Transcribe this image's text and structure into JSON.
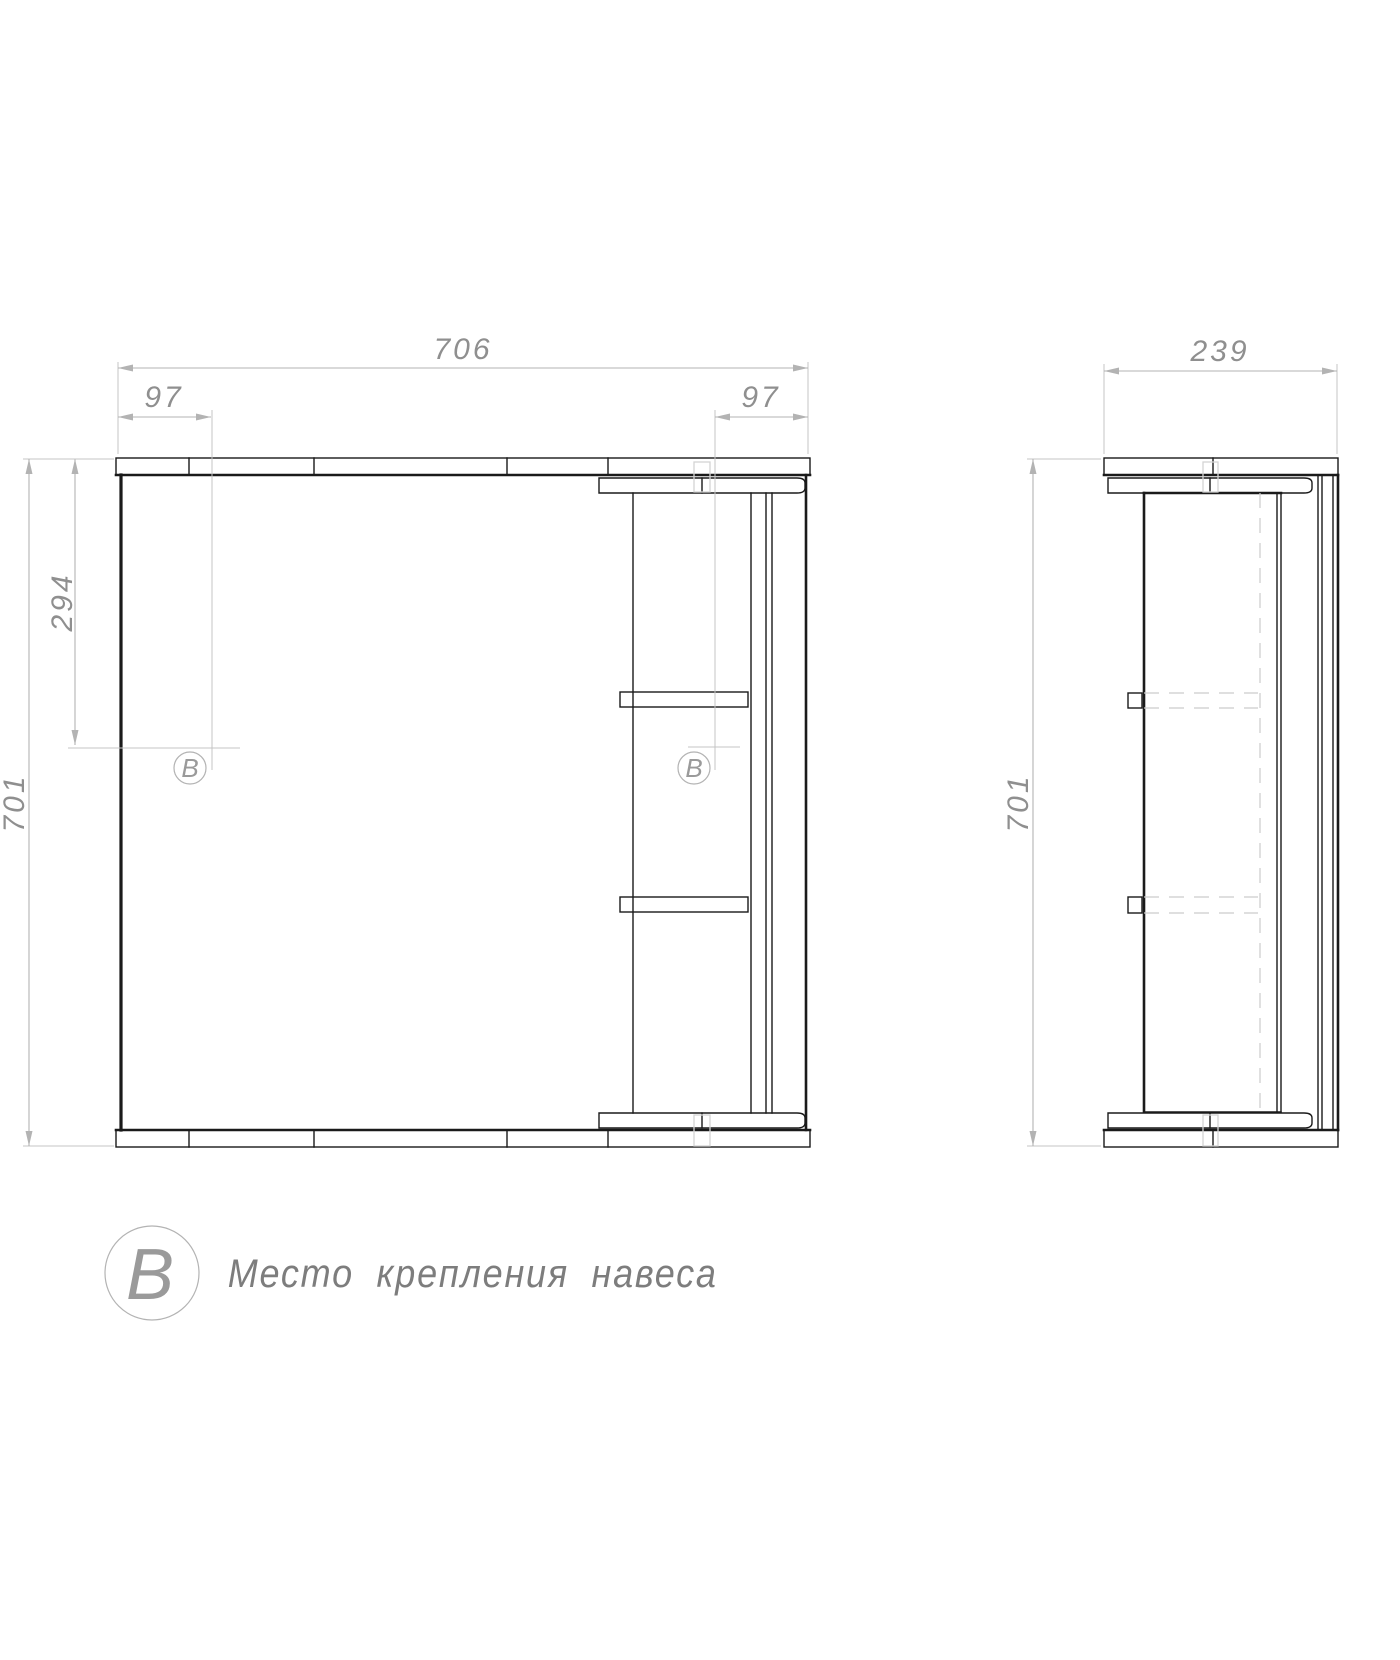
{
  "page": {
    "background": "#ffffff"
  },
  "dimensions": {
    "front_width": "706",
    "front_left_offset": "97",
    "front_right_offset": "97",
    "mount_from_top": "294",
    "front_height": "701",
    "side_depth": "239",
    "side_height": "701"
  },
  "markers": {
    "front_left": "В",
    "front_right": "В"
  },
  "legend": {
    "symbol": "В",
    "label": "Место крепления навеса"
  },
  "colors": {
    "background": "#ffffff",
    "line": "#1a1a1a",
    "dim": "#b3b3b3",
    "ext": "#c4c4c4",
    "hidden": "#cccccc",
    "hole": "#d4d4d4",
    "dim_text": "#8f8f8f",
    "marker": "#9a9a9a",
    "legend_text": "#7d7d7d"
  }
}
